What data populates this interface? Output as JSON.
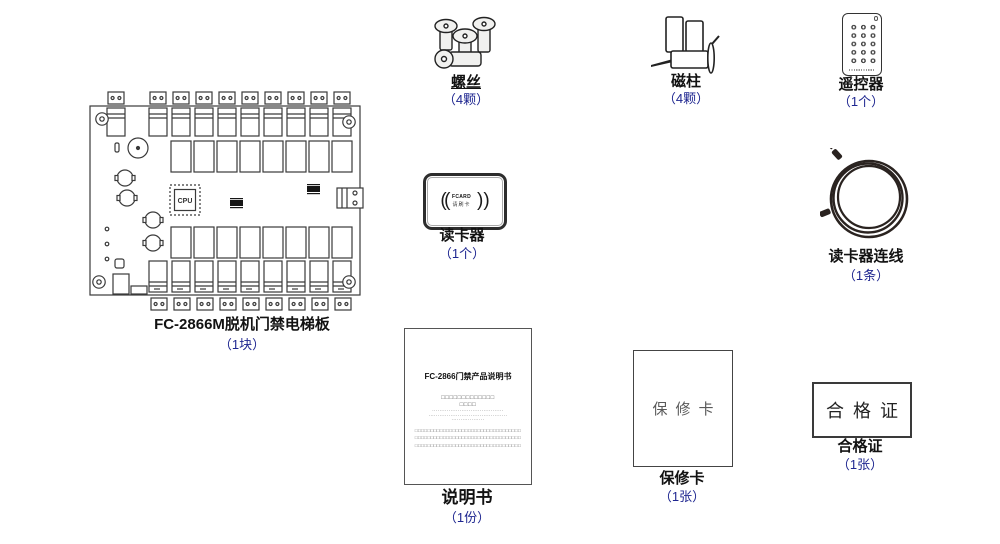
{
  "meta": {
    "accent_blue": "#1e2690",
    "text_black": "#121212",
    "background": "#ffffff"
  },
  "items": {
    "board": {
      "label": "FC-2866M脱机门禁电梯板",
      "count": "（1块）",
      "cpu": "CPU"
    },
    "screws": {
      "label": "螺丝",
      "count": "（4颗）"
    },
    "magnets": {
      "label": "磁柱",
      "count": "（4颗）"
    },
    "remote": {
      "label": "遥控器",
      "count": "（1个）"
    },
    "reader": {
      "label": "读卡器",
      "count": "（1个）",
      "waves_open": "((",
      "waves_close": "))",
      "brand": "FCARD",
      "hint": "请刷卡"
    },
    "cable": {
      "label": "读卡器连线",
      "count": "（1条）"
    },
    "manual": {
      "label": "说明书",
      "count": "（1份）",
      "title": "FC-2866门禁产品说明书",
      "lines": [
        "□□□□□□□□□□□□□",
        "□□□□",
        "·······································",
        "···········································",
        "··················",
        "□□□□□□□□□□□□□□□□□□□□□□□□□□□□□□□□□□",
        "□□□□□□□□□□□□□□□□□□□□□□□□□□□□□□□□□□",
        "□□□□□□□□□□□□□□□□□□□□□□□□□□□□□□□□□□"
      ]
    },
    "warranty": {
      "label": "保修卡",
      "count": "（1张）",
      "inner": "保修卡"
    },
    "certificate": {
      "label": "合格证",
      "count": "（1张）",
      "inner": "合格证"
    }
  }
}
